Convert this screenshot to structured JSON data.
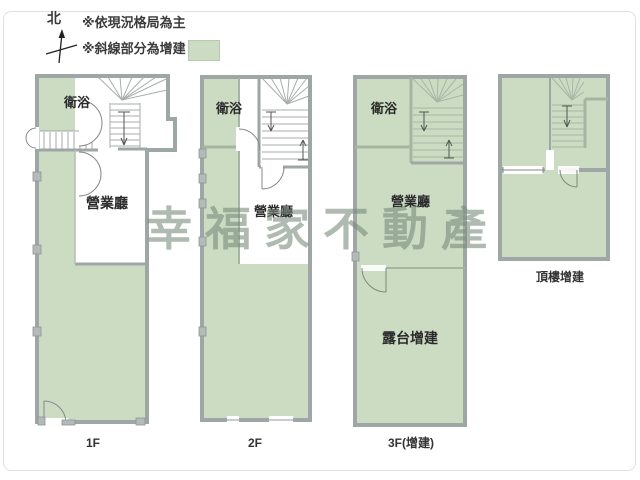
{
  "legend": {
    "compass": "北",
    "note_layout": "※依現況格局為主",
    "note_addition": "※斜線部分為增建",
    "swatch_color": "#cbdcc2"
  },
  "watermark": {
    "text": "幸福家不動產"
  },
  "floors": [
    {
      "label": "1F",
      "bath": "衛浴",
      "hall": "營業廳"
    },
    {
      "label": "2F",
      "bath": "衛浴",
      "hall": "營業廳"
    },
    {
      "label": "3F(增建)",
      "bath": "衛浴",
      "hall": "營業廳",
      "terrace": "露台增建"
    },
    {
      "label": "頂樓增建"
    }
  ],
  "colors": {
    "floor_fill": "#cbdcc2",
    "outer_wall": "#9fa6a6",
    "green_wall": "#a4b5a0",
    "watermark": "#7a8c7c"
  }
}
